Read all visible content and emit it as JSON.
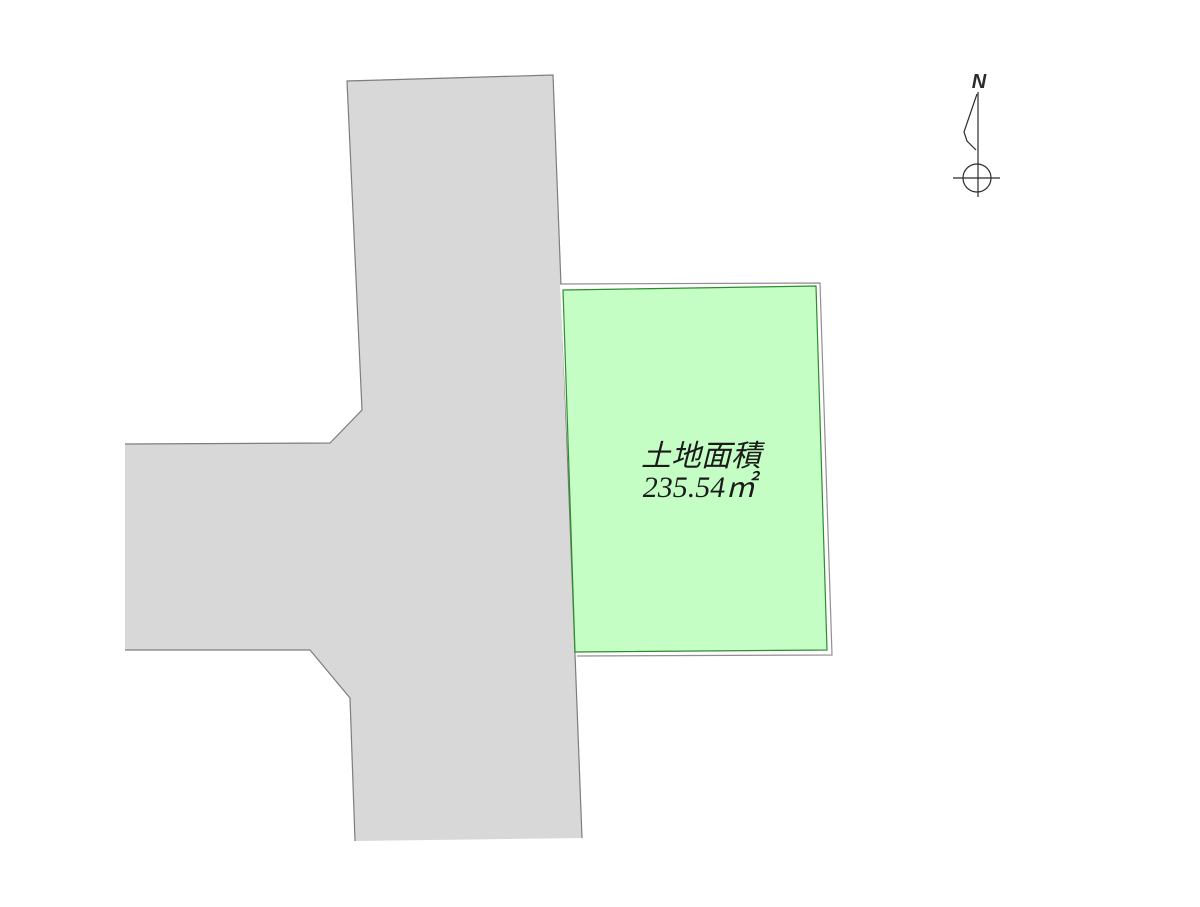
{
  "drawing": {
    "parcel": {
      "area_label": "土地面積",
      "area_value": "235.54㎡"
    },
    "compass": {
      "north_label": "N"
    },
    "colors": {
      "background": "#ffffff",
      "road_fill": "#d8d8d8",
      "road_stroke": "#7d7d7d",
      "boundary_stroke": "#8f8f8f",
      "parcel_fill": "#c5fec5",
      "parcel_stroke": "#2e8b2e",
      "text_color": "#1b1b1b",
      "compass_stroke": "#2b2b2b"
    }
  }
}
